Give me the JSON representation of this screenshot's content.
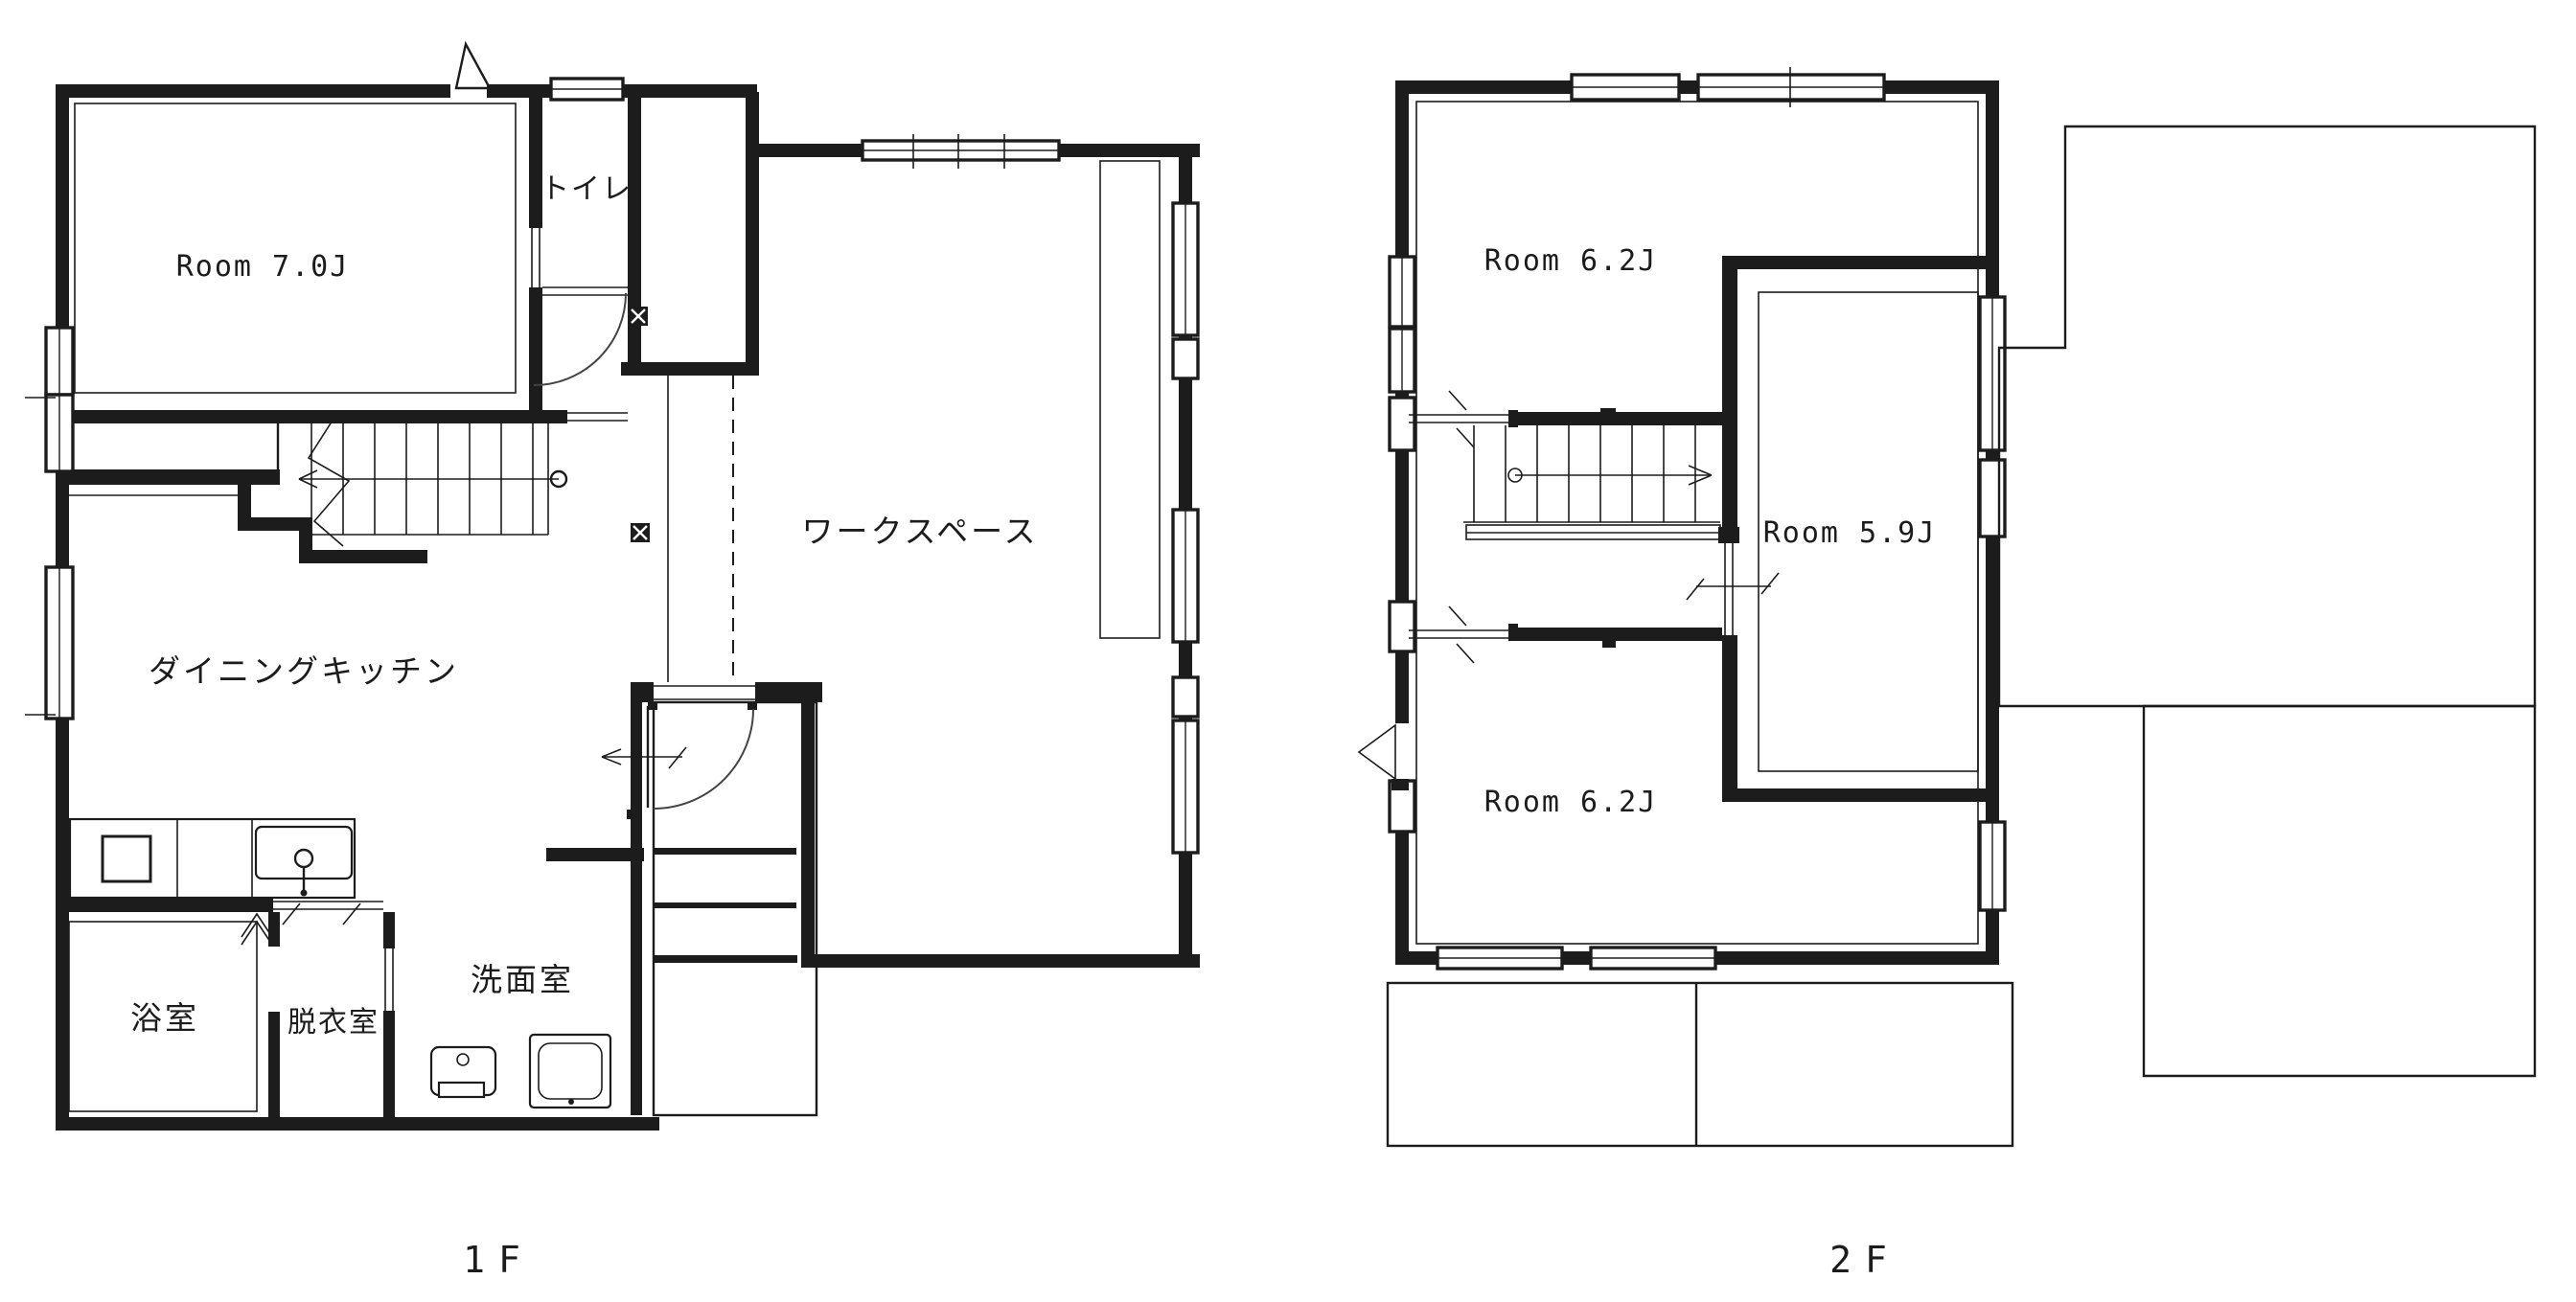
{
  "drawing": {
    "type": "floor-plan",
    "background": "#ffffff",
    "line_color": "#1c1c1c"
  },
  "floor1": {
    "caption": "1F",
    "rooms": {
      "room_7_0j": "Room 7.0J",
      "toilet": "トイレ",
      "workspace": "ワークスペース",
      "dining_kitchen": "ダイニングキッチン",
      "bath": "浴室",
      "dressing_room": "脱衣室",
      "washroom": "洗面室"
    }
  },
  "floor2": {
    "caption": "2F",
    "rooms": {
      "room_6_2j_north": "Room 6.2J",
      "room_5_9j": "Room 5.9J",
      "room_6_2j_south": "Room 6.2J"
    }
  }
}
